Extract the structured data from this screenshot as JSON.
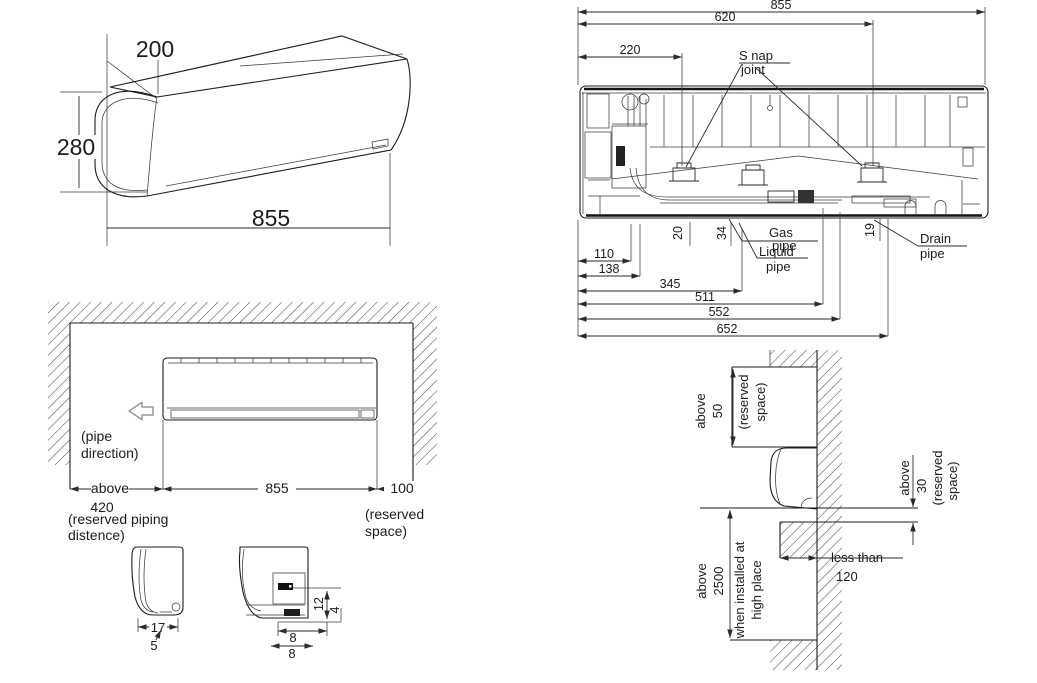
{
  "colors": {
    "line": "#1c1c1c",
    "hatch": "#4d4d4d",
    "background": "#ffffff"
  },
  "unit_3d": {
    "depth": "200",
    "height": "280",
    "width": "855"
  },
  "rear_view": {
    "width_total": "855",
    "width_620": "620",
    "width_220": "220",
    "snap_joint_line1": "S nap",
    "snap_joint_line2": "joint",
    "dim_110": "110",
    "dim_138": "138",
    "dim_345": "345",
    "dim_511": "511",
    "dim_552": "552",
    "dim_652": "652",
    "dim_20": "20",
    "dim_34": "34",
    "dim_19": "19",
    "gas_pipe_line1": "Gas",
    "gas_pipe_line2": "pipe",
    "liquid_pipe_line1": "Liquid",
    "liquid_pipe_line2": "pipe",
    "drain_pipe_line1": "Drain",
    "drain_pipe_line2": "pipe"
  },
  "install_front": {
    "pipe_direction_line1": "(pipe",
    "pipe_direction_line2": "direction)",
    "above_label": "above",
    "dim_420": "420",
    "reserved_piping_line1": "(reserved piping",
    "reserved_piping_line2": "distence)",
    "dim_855": "855",
    "dim_100": "100",
    "reserved_space_line1": "(reserved",
    "reserved_space_line2": "space)",
    "detail_dim_17": "17",
    "detail_dim_5": "5",
    "detail_dim_12": "12",
    "detail_dim_4": "4",
    "detail_dim_8a": "8",
    "detail_dim_8b": "8"
  },
  "install_side": {
    "top_above": "above",
    "top_50": "50",
    "top_reserved_line1": "(reserved",
    "top_reserved_line2": "space)",
    "right_above": "above",
    "right_30": "30",
    "right_reserved_line1": "(reserved",
    "right_reserved_line2": "space)",
    "left_above": "above",
    "left_2500": "2500",
    "left_note_line1": "when installed at",
    "left_note_line2": "high place",
    "less_than": "less than",
    "dim_120": "120"
  }
}
